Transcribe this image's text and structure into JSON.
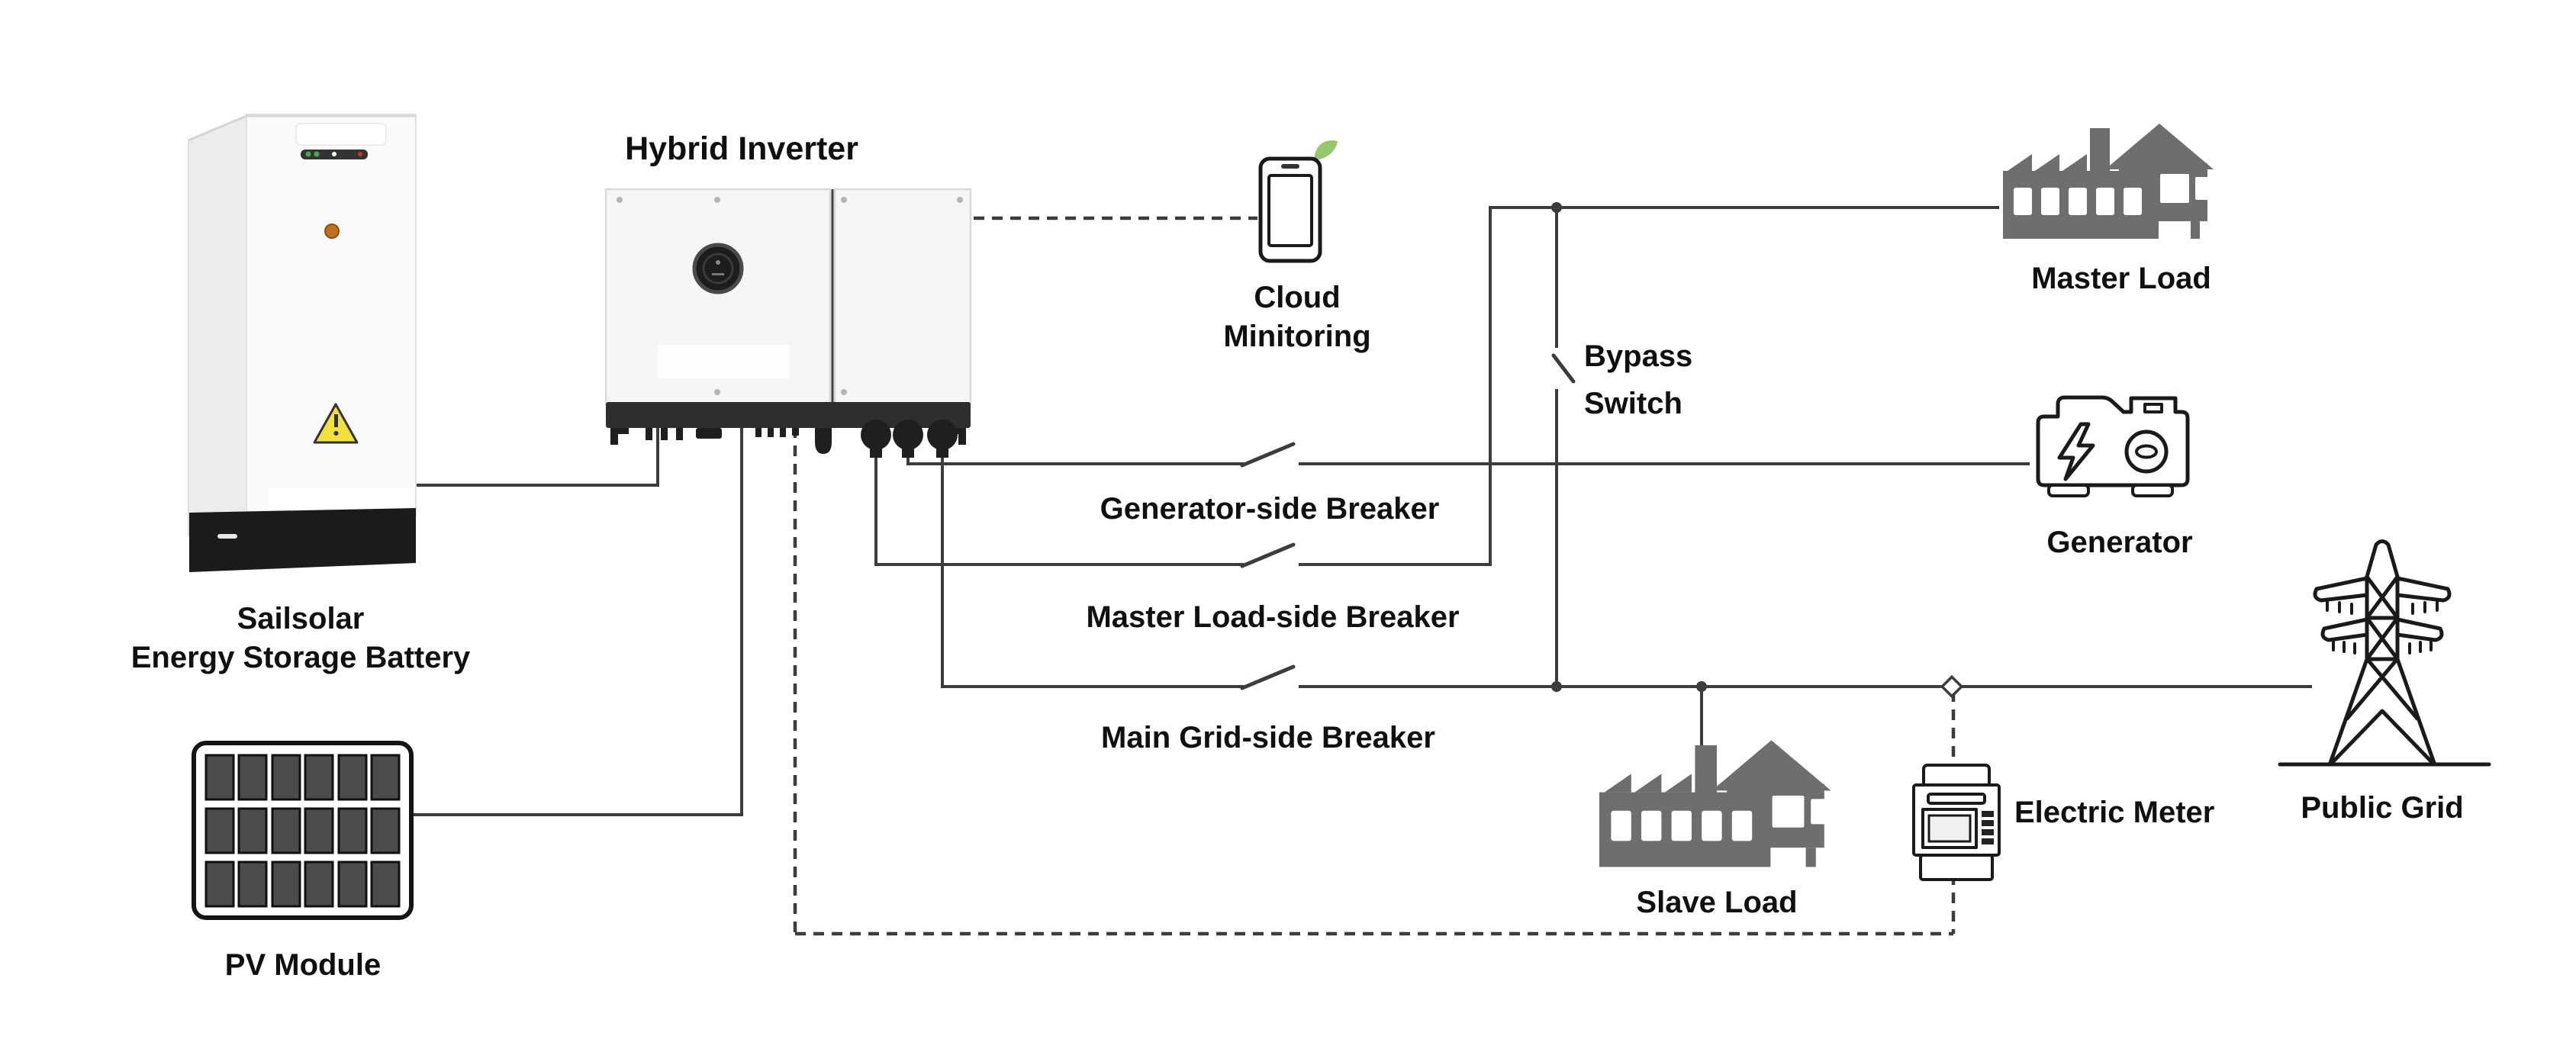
{
  "labels": {
    "title": "Hybrid Inverter",
    "battery1": "Sailsolar",
    "battery2": "Energy Storage Battery",
    "pv": "PV Module",
    "cloud1": "Cloud",
    "cloud2": "Minitoring",
    "bypass1": "Bypass",
    "bypass2": "Switch",
    "gen_breaker": "Generator-side Breaker",
    "ml_breaker": "Master Load-side Breaker",
    "mg_breaker": "Main Grid-side Breaker",
    "master_load": "Master Load",
    "generator": "Generator",
    "slave_load": "Slave Load",
    "meter": "Electric Meter",
    "grid": "Public Grid"
  },
  "theme": {
    "line": "#3c3c3c",
    "icon_gray": "#6e6e6e",
    "icon_outline": "#1a1a1a",
    "leaf_green": "#97c76c",
    "warning_yellow": "#f2e13c",
    "indicator_orange": "#c0701e",
    "led_green": "#49a84c",
    "led_red": "#c0392b"
  }
}
